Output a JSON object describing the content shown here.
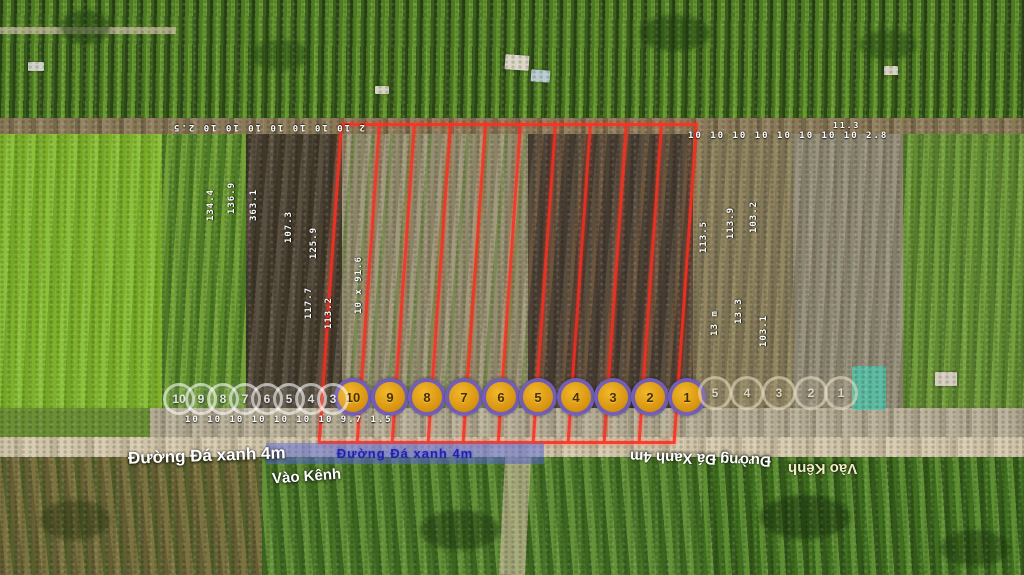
{
  "photo": {
    "type": "aerial-drone-photo",
    "subject": "farmland with surveyed land plots outlined in red for sale"
  },
  "overlay": {
    "colors": {
      "boundary": "#ff2d1e",
      "marker_fill": "#e8a818",
      "marker_ring": "#544ee0",
      "dimension_text": "#ffffff",
      "ribbon": "#5b68d6"
    },
    "top_dims_left": "2 10 10 10 10 10 10 10 2.5",
    "top_dims_right": "10 10 10 10 10 10 10 10 2.8",
    "top_dim_extra": "11.3",
    "road_dims": "10 10 10 10 10 10 10 9.7 1.5",
    "side_dim": "10 x 91.6",
    "vdims_left": [
      "134.4",
      "136.9",
      "363.1",
      "107.3",
      "125.9",
      "117.7",
      "113.2"
    ],
    "vdims_right": [
      "113.5",
      "113.9",
      "103.2",
      "13.3",
      "13 m",
      "103.1"
    ],
    "markers": {
      "yellow_numbers": [
        "10",
        "9",
        "8",
        "7",
        "6",
        "5",
        "4",
        "3",
        "2",
        "1"
      ],
      "ghost_left_numbers": [
        "10",
        "9",
        "8",
        "7",
        "6",
        "5",
        "4",
        "3"
      ],
      "ghost_right_numbers": [
        "5",
        "4",
        "3",
        "2",
        "1"
      ]
    },
    "labels": {
      "road_left": "Đường Đá xanh 4m",
      "canal_mid": "Vào Kênh",
      "ribbon": "Đường Đá xanh 4m",
      "road_right": "Đường Đá Xanh 4m",
      "canal_right": "Vào Kênh"
    }
  }
}
